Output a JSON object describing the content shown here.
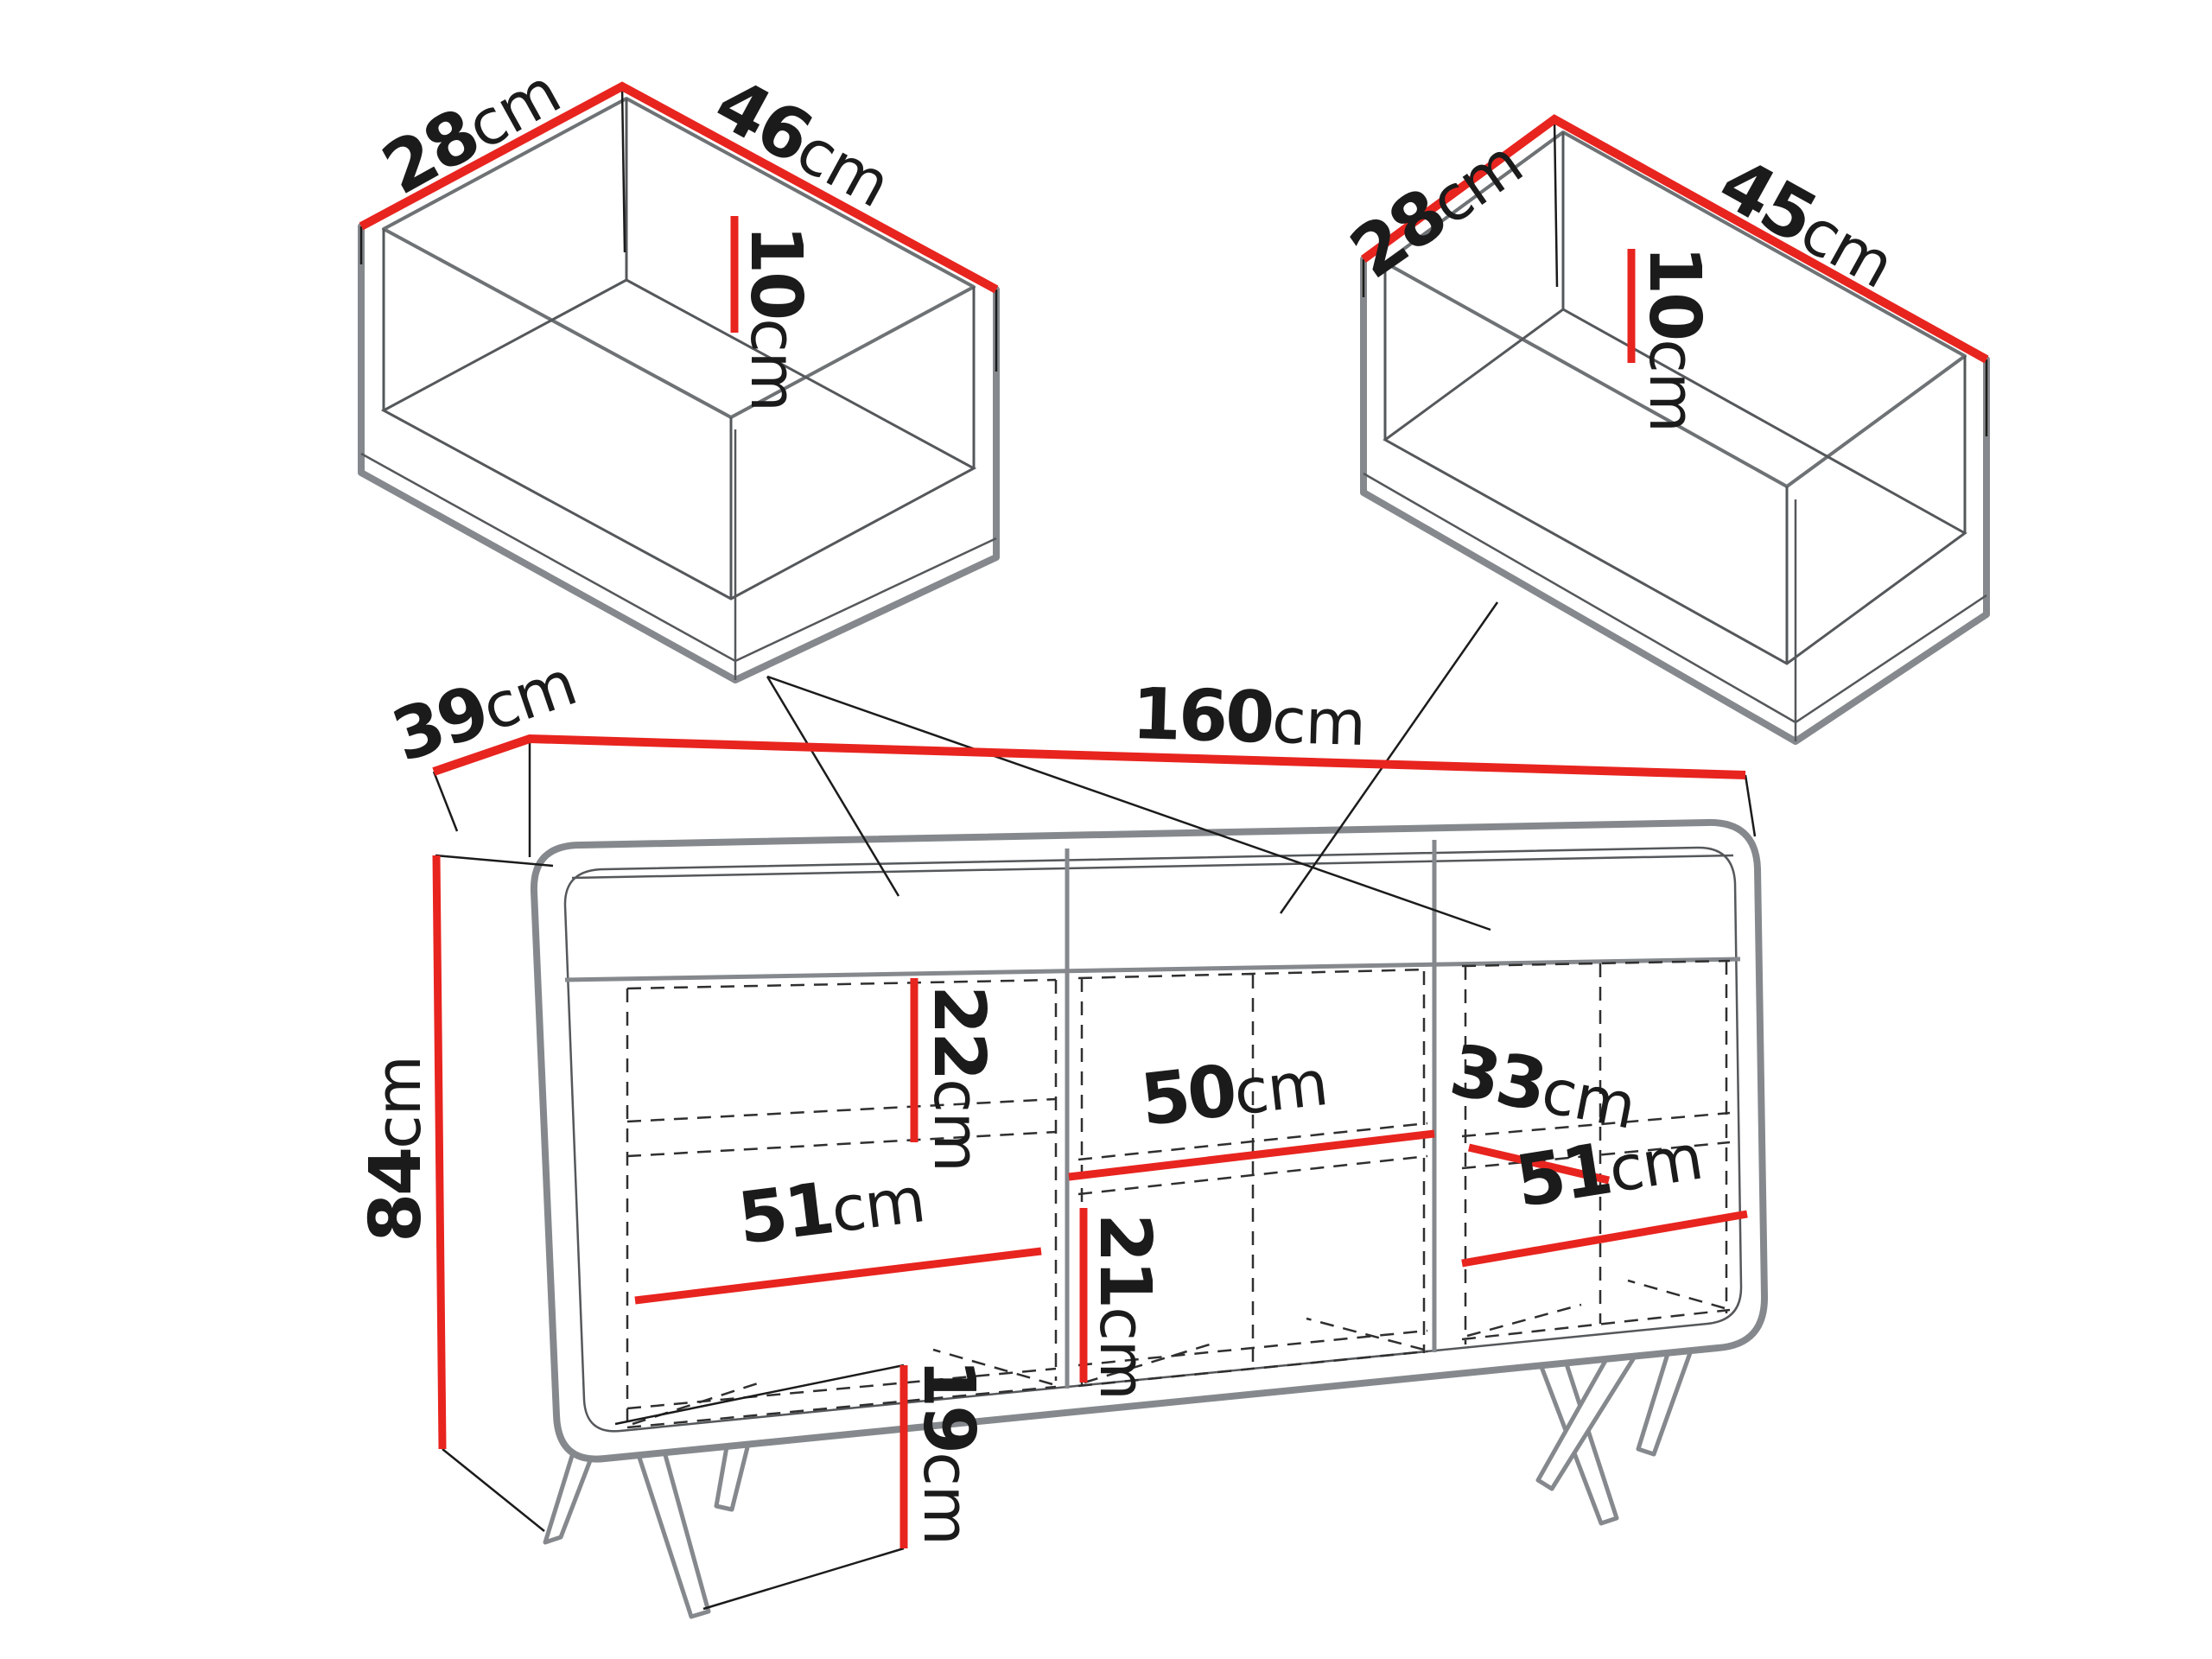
{
  "diagram": {
    "type": "furniture-dimension-diagram",
    "colors": {
      "dimension_red": "#E8241F",
      "outline_gray": "#85898D",
      "text_black": "#1B1B1B"
    },
    "drawer_left": {
      "width": {
        "value": "28",
        "unit": "cm"
      },
      "depth": {
        "value": "46",
        "unit": "cm"
      },
      "inner_height": {
        "value": "10",
        "unit": "cm"
      }
    },
    "drawer_right": {
      "width": {
        "value": "28",
        "unit": "cm"
      },
      "depth": {
        "value": "45",
        "unit": "cm"
      },
      "inner_height": {
        "value": "10",
        "unit": "cm"
      }
    },
    "cabinet": {
      "depth": {
        "value": "39",
        "unit": "cm"
      },
      "width": {
        "value": "160",
        "unit": "cm"
      },
      "height": {
        "value": "84",
        "unit": "cm"
      },
      "left_top_opening_height": {
        "value": "22",
        "unit": "cm"
      },
      "middle_opening_width": {
        "value": "50",
        "unit": "cm"
      },
      "right_opening_depth": {
        "value": "33",
        "unit": "cm"
      },
      "right_opening_width": {
        "value": "51",
        "unit": "cm"
      },
      "left_opening_width": {
        "value": "51",
        "unit": "cm"
      },
      "middle_bottom_opening_height": {
        "value": "21",
        "unit": "cm"
      },
      "leg_height": {
        "value": "19",
        "unit": "cm"
      }
    }
  }
}
